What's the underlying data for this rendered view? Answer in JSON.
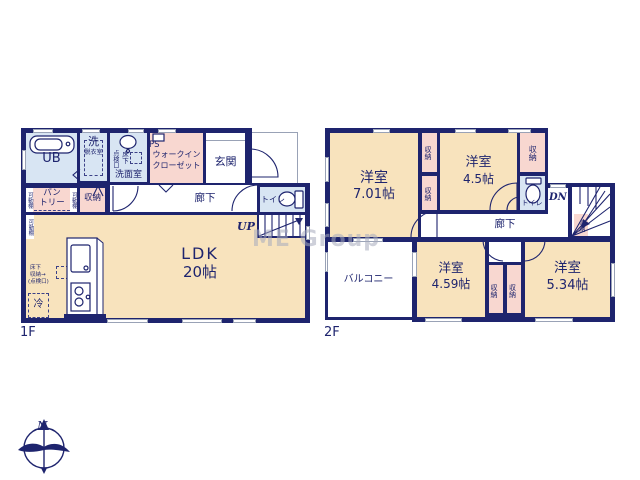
{
  "palette": {
    "wall_navy": "#1e246e",
    "room_cream": "#f8e3bd",
    "closet_pink": "#f8d7d0",
    "wet_area_blue": "#d8e5f3",
    "window_gray": "#99a2b6",
    "watermark_gray": "#a7abbd"
  },
  "watermark": "ME Group",
  "compass": {
    "north": "N"
  },
  "floor1": {
    "name": "1F",
    "ub": "UB",
    "wash": "洗",
    "dressing": "脱衣室",
    "inspection": "点検口",
    "underfloor": "床下",
    "washroom": "洗面室",
    "ps": "PS",
    "wic_line1": "ウォークイン",
    "wic_line2": "クローゼット",
    "entrance": "玄関",
    "shelf": "可動棚",
    "pantry_line1": "パン",
    "pantry_line2": "トリー",
    "storage": "収納",
    "hall": "廊下",
    "toilet": "トイレ",
    "up": "UP",
    "ldk": "LDK",
    "ldk_size": "20帖",
    "uf1": "床下",
    "uf2": "収納→",
    "uf3": "(点検口)",
    "fridge": "冷"
  },
  "floor2": {
    "name": "2F",
    "room": "洋室",
    "size701": "7.01帖",
    "size45": "4.5帖",
    "size459": "4.59帖",
    "size534": "5.34帖",
    "storage": "収納",
    "toilet": "トイレ",
    "dn": "DN",
    "hall": "廊下",
    "balcony": "バルコニー"
  }
}
